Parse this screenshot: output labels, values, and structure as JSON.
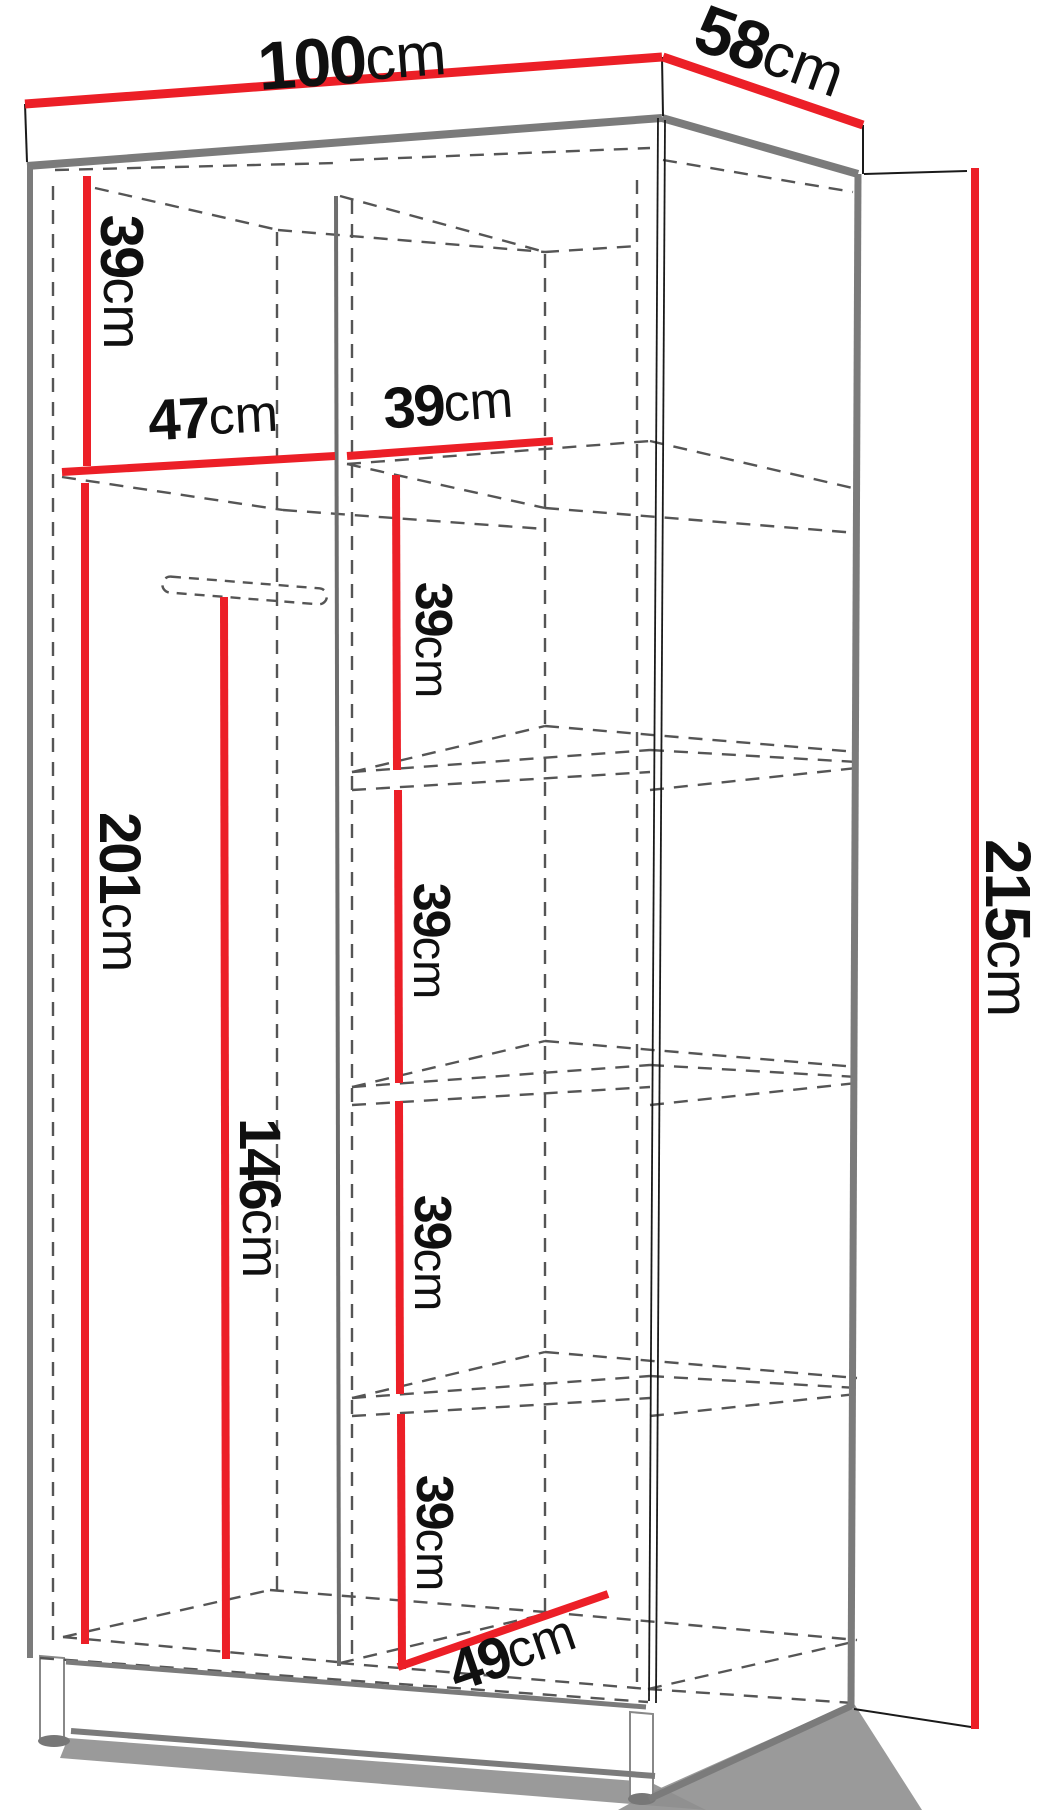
{
  "canvas": {
    "width": 1052,
    "height": 1810
  },
  "colors": {
    "dimension_red": "#ec1f27",
    "edge_gray": "#7b7b7b",
    "divider_gray": "#6e6e6e",
    "hidden_dash": "#555555",
    "thin_black": "#1a1a1a",
    "shadow_gray": "#8f8f8f",
    "foot_outline": "#888888",
    "background": "#ffffff"
  },
  "measurements_summary": {
    "overall_width": "100cm",
    "overall_depth": "58cm",
    "overall_height": "215cm",
    "top_compartment_height": "39cm",
    "left_bay_width": "47cm",
    "right_bay_width": "39cm",
    "left_bay_height": "201cm",
    "hanging_height": "146cm",
    "right_shelf_spacing": [
      "39cm",
      "39cm",
      "39cm",
      "39cm"
    ],
    "interior_depth": "49cm"
  },
  "diagram": {
    "labels": [
      {
        "name": "label-100cm",
        "value": "100",
        "unit": "cm",
        "x": 352,
        "y": 60,
        "rot": -4.3,
        "size": 68,
        "unit_size": 61
      },
      {
        "name": "label-58cm",
        "value": "58",
        "unit": "cm",
        "x": 770,
        "y": 52,
        "rot": 20,
        "size": 68,
        "unit_size": 61
      },
      {
        "name": "label-39cm-top-left",
        "value": "39",
        "unit": "cm",
        "x": 122,
        "y": 282,
        "rot": 90,
        "size": 60,
        "unit_size": 54
      },
      {
        "name": "label-47cm",
        "value": "47",
        "unit": "cm",
        "x": 213,
        "y": 417,
        "rot": -3,
        "size": 58,
        "unit_size": 52
      },
      {
        "name": "label-39cm-width",
        "value": "39",
        "unit": "cm",
        "x": 448,
        "y": 404,
        "rot": -4,
        "size": 58,
        "unit_size": 52
      },
      {
        "name": "label-201cm",
        "value": "201",
        "unit": "cm",
        "x": 120,
        "y": 892,
        "rot": 90,
        "size": 58,
        "unit_size": 52
      },
      {
        "name": "label-146cm",
        "value": "146",
        "unit": "cm",
        "x": 260,
        "y": 1198,
        "rot": 90,
        "size": 58,
        "unit_size": 52
      },
      {
        "name": "label-39cm-bay1",
        "value": "39",
        "unit": "cm",
        "x": 433,
        "y": 640,
        "rot": 90,
        "size": 52,
        "unit_size": 47
      },
      {
        "name": "label-39cm-bay2",
        "value": "39",
        "unit": "cm",
        "x": 431,
        "y": 941,
        "rot": 90,
        "size": 52,
        "unit_size": 47
      },
      {
        "name": "label-39cm-bay3",
        "value": "39",
        "unit": "cm",
        "x": 432,
        "y": 1253,
        "rot": 90,
        "size": 52,
        "unit_size": 47
      },
      {
        "name": "label-39cm-bay4",
        "value": "39",
        "unit": "cm",
        "x": 434,
        "y": 1533,
        "rot": 90,
        "size": 52,
        "unit_size": 47
      },
      {
        "name": "label-49cm",
        "value": "49",
        "unit": "cm",
        "x": 512,
        "y": 1652,
        "rot": -19,
        "size": 58,
        "unit_size": 52
      },
      {
        "name": "label-215cm",
        "value": "215",
        "unit": "cm",
        "x": 1008,
        "y": 928,
        "rot": 90,
        "size": 64,
        "unit_size": 58
      }
    ],
    "red_lines": [
      {
        "name": "dim-line-100cm",
        "x1": 25,
        "y1": 104,
        "x2": 662,
        "y2": 57,
        "w": 9
      },
      {
        "name": "dim-line-58cm",
        "x1": 663,
        "y1": 57,
        "x2": 863,
        "y2": 125,
        "w": 9
      },
      {
        "name": "dim-line-39cm-top",
        "x1": 87,
        "y1": 176,
        "x2": 87,
        "y2": 466,
        "w": 8
      },
      {
        "name": "dim-line-47cm",
        "x1": 62,
        "y1": 472,
        "x2": 335,
        "y2": 456,
        "w": 8
      },
      {
        "name": "dim-line-39cm-width",
        "x1": 347,
        "y1": 456,
        "x2": 553,
        "y2": 441,
        "w": 8
      },
      {
        "name": "dim-line-201cm",
        "x1": 85,
        "y1": 483,
        "x2": 85,
        "y2": 1644,
        "w": 8
      },
      {
        "name": "dim-line-146cm",
        "x1": 224,
        "y1": 597,
        "x2": 226,
        "y2": 1659,
        "w": 8
      },
      {
        "name": "dim-line-39cm-seg1",
        "x1": 396,
        "y1": 475,
        "x2": 397,
        "y2": 770,
        "w": 8
      },
      {
        "name": "dim-line-39cm-seg2",
        "x1": 398,
        "y1": 790,
        "x2": 399,
        "y2": 1083,
        "w": 8
      },
      {
        "name": "dim-line-39cm-seg3",
        "x1": 399,
        "y1": 1101,
        "x2": 400,
        "y2": 1394,
        "w": 8
      },
      {
        "name": "dim-line-39cm-seg4",
        "x1": 401,
        "y1": 1414,
        "x2": 402,
        "y2": 1669,
        "w": 8
      },
      {
        "name": "dim-line-49cm",
        "x1": 398,
        "y1": 1667,
        "x2": 608,
        "y2": 1594,
        "w": 8
      },
      {
        "name": "dim-line-215cm",
        "x1": 975,
        "y1": 168,
        "x2": 975,
        "y2": 1729,
        "w": 8
      }
    ],
    "gray_edges": [
      {
        "name": "edge-top-front",
        "x1": 27,
        "y1": 166,
        "x2": 662,
        "y2": 118,
        "w": 8
      },
      {
        "name": "edge-top-right",
        "x1": 662,
        "y1": 118,
        "x2": 858,
        "y2": 174,
        "w": 8
      },
      {
        "name": "edge-left",
        "x1": 30,
        "y1": 163,
        "x2": 30,
        "y2": 1658,
        "w": 6
      },
      {
        "name": "edge-back-right",
        "x1": 858,
        "y1": 174,
        "x2": 851,
        "y2": 1708,
        "w": 7
      },
      {
        "name": "edge-right-bottom",
        "x1": 851,
        "y1": 1706,
        "x2": 649,
        "y2": 1799,
        "w": 7
      },
      {
        "name": "edge-plinth-top",
        "x1": 66,
        "y1": 1662,
        "x2": 646,
        "y2": 1707,
        "w": 5
      },
      {
        "name": "edge-plinth-bottom",
        "x1": 71,
        "y1": 1731,
        "x2": 655,
        "y2": 1776,
        "w": 6
      },
      {
        "name": "edge-center-divider",
        "x1": 336,
        "y1": 196,
        "x2": 339,
        "y2": 1666,
        "w": 4
      }
    ],
    "thin_lines": [
      {
        "name": "edge-toppanel-left",
        "x1": 25,
        "y1": 104,
        "x2": 27,
        "y2": 162,
        "w": 2
      },
      {
        "name": "edge-toppanel-corner",
        "x1": 662,
        "y1": 57,
        "x2": 663,
        "y2": 116,
        "w": 2
      },
      {
        "name": "edge-toppanel-backcorner",
        "x1": 863,
        "y1": 125,
        "x2": 863,
        "y2": 174,
        "w": 2
      },
      {
        "name": "extension-line-top",
        "x1": 864,
        "y1": 174,
        "x2": 967,
        "y2": 171,
        "w": 2
      },
      {
        "name": "extension-line-bottom",
        "x1": 854,
        "y1": 1709,
        "x2": 971,
        "y2": 1727,
        "w": 2
      },
      {
        "name": "edge-front-right-a",
        "x1": 658,
        "y1": 118,
        "x2": 649,
        "y2": 1701,
        "w": 1.8
      },
      {
        "name": "edge-front-right-b",
        "x1": 665,
        "y1": 120,
        "x2": 656,
        "y2": 1703,
        "w": 1.8
      }
    ],
    "dashed_lines": [
      {
        "name": "hidden-top-underside-left",
        "x1": 55,
        "y1": 170,
        "x2": 335,
        "y2": 163
      },
      {
        "name": "hidden-top-underside-right",
        "x1": 350,
        "y1": 160,
        "x2": 650,
        "y2": 148
      },
      {
        "name": "hidden-top-back-diag-left",
        "x1": 95,
        "y1": 188,
        "x2": 278,
        "y2": 230
      },
      {
        "name": "hidden-top-back-left",
        "x1": 278,
        "y1": 230,
        "x2": 545,
        "y2": 252
      },
      {
        "name": "hidden-top-divider-diag",
        "x1": 340,
        "y1": 196,
        "x2": 545,
        "y2": 252
      },
      {
        "name": "hidden-top-back-right",
        "x1": 545,
        "y1": 252,
        "x2": 637,
        "y2": 246
      },
      {
        "name": "hidden-top-rightwall",
        "x1": 663,
        "y1": 160,
        "x2": 853,
        "y2": 192
      },
      {
        "name": "hidden-left-inner",
        "x1": 53,
        "y1": 186,
        "x2": 53,
        "y2": 1650
      },
      {
        "name": "hidden-back-left-corner",
        "x1": 277,
        "y1": 232,
        "x2": 277,
        "y2": 1590
      },
      {
        "name": "hidden-divider-front2",
        "x1": 352,
        "y1": 200,
        "x2": 352,
        "y2": 1663
      },
      {
        "name": "hidden-divider-back",
        "x1": 545,
        "y1": 254,
        "x2": 545,
        "y2": 1612
      },
      {
        "name": "hidden-rightwall-back",
        "x1": 637,
        "y1": 180,
        "x2": 637,
        "y2": 1692
      },
      {
        "name": "shelf0-left-diag",
        "x1": 62,
        "y1": 477,
        "x2": 283,
        "y2": 510
      },
      {
        "name": "shelf0-left-back",
        "x1": 283,
        "y1": 510,
        "x2": 545,
        "y2": 529
      },
      {
        "name": "shelf0-right-under",
        "x1": 347,
        "y1": 464,
        "x2": 650,
        "y2": 441
      },
      {
        "name": "shelf0-right-diag",
        "x1": 347,
        "y1": 464,
        "x2": 545,
        "y2": 508
      },
      {
        "name": "shelf0-right-back",
        "x1": 545,
        "y1": 508,
        "x2": 857,
        "y2": 533
      },
      {
        "name": "shelf0-panel-cross",
        "x1": 650,
        "y1": 441,
        "x2": 857,
        "y2": 489
      },
      {
        "name": "shelf1-front-top",
        "x1": 352,
        "y1": 772,
        "x2": 650,
        "y2": 750
      },
      {
        "name": "shelf1-front-bottom",
        "x1": 352,
        "y1": 790,
        "x2": 650,
        "y2": 772
      },
      {
        "name": "shelf1-left-diag",
        "x1": 352,
        "y1": 772,
        "x2": 545,
        "y2": 726
      },
      {
        "name": "shelf1-back",
        "x1": 545,
        "y1": 726,
        "x2": 857,
        "y2": 752
      },
      {
        "name": "shelf1-panel-cross-top",
        "x1": 650,
        "y1": 750,
        "x2": 857,
        "y2": 762
      },
      {
        "name": "shelf1-panel-cross-bottom",
        "x1": 650,
        "y1": 790,
        "x2": 857,
        "y2": 768
      },
      {
        "name": "shelf2-front-top",
        "x1": 352,
        "y1": 1087,
        "x2": 650,
        "y2": 1065
      },
      {
        "name": "shelf2-front-bottom",
        "x1": 352,
        "y1": 1105,
        "x2": 650,
        "y2": 1087
      },
      {
        "name": "shelf2-left-diag",
        "x1": 352,
        "y1": 1087,
        "x2": 545,
        "y2": 1041
      },
      {
        "name": "shelf2-back",
        "x1": 545,
        "y1": 1041,
        "x2": 857,
        "y2": 1067
      },
      {
        "name": "shelf2-panel-cross-top",
        "x1": 650,
        "y1": 1065,
        "x2": 857,
        "y2": 1077
      },
      {
        "name": "shelf2-panel-cross-bottom",
        "x1": 650,
        "y1": 1105,
        "x2": 857,
        "y2": 1083
      },
      {
        "name": "shelf3-front-top",
        "x1": 352,
        "y1": 1398,
        "x2": 650,
        "y2": 1376
      },
      {
        "name": "shelf3-front-bottom",
        "x1": 352,
        "y1": 1416,
        "x2": 650,
        "y2": 1398
      },
      {
        "name": "shelf3-left-diag",
        "x1": 352,
        "y1": 1398,
        "x2": 545,
        "y2": 1352
      },
      {
        "name": "shelf3-back",
        "x1": 545,
        "y1": 1352,
        "x2": 857,
        "y2": 1378
      },
      {
        "name": "shelf3-panel-cross-top",
        "x1": 650,
        "y1": 1376,
        "x2": 857,
        "y2": 1388
      },
      {
        "name": "shelf3-panel-cross-bottom",
        "x1": 650,
        "y1": 1416,
        "x2": 857,
        "y2": 1394
      },
      {
        "name": "floor-front-left",
        "x1": 63,
        "y1": 1637,
        "x2": 337,
        "y2": 1662
      },
      {
        "name": "floor-front-right",
        "x1": 340,
        "y1": 1663,
        "x2": 648,
        "y2": 1689
      },
      {
        "name": "floor-left-diag",
        "x1": 63,
        "y1": 1637,
        "x2": 270,
        "y2": 1590
      },
      {
        "name": "floor-back-left",
        "x1": 270,
        "y1": 1590,
        "x2": 545,
        "y2": 1612
      },
      {
        "name": "floor-back-right",
        "x1": 545,
        "y1": 1612,
        "x2": 857,
        "y2": 1640
      },
      {
        "name": "floor-divider-diag",
        "x1": 340,
        "y1": 1663,
        "x2": 545,
        "y2": 1614
      },
      {
        "name": "floor-right-diag",
        "x1": 648,
        "y1": 1689,
        "x2": 857,
        "y2": 1641
      },
      {
        "name": "hidden-bottom-front",
        "x1": 40,
        "y1": 1658,
        "x2": 648,
        "y2": 1702
      },
      {
        "name": "hidden-bottom-right-cross",
        "x1": 648,
        "y1": 1689,
        "x2": 853,
        "y2": 1703
      }
    ],
    "rail": {
      "name": "hanging-rail",
      "x": 163,
      "y": 576,
      "w": 165,
      "h": 16,
      "rx": 8,
      "rot": 4.5
    },
    "polygons": [
      {
        "name": "shadow-plinth",
        "points": "68,1738 650,1782 706,1810 60,1758",
        "fill": "#8f8f8f",
        "opacity": 0.9
      },
      {
        "name": "shadow-right-panel",
        "points": "853,1702 922,1810 618,1810 645,1795",
        "fill": "#8f8f8f",
        "opacity": 0.9
      },
      {
        "name": "panel-top-front",
        "points": "25,104 662,57 663,115 27,163",
        "fill": "#ffffff"
      },
      {
        "name": "panel-top-side",
        "points": "663,57 863,125 863,175 664,117",
        "fill": "#ffffff"
      },
      {
        "name": "panel-right-side",
        "points": "662,117 858,175 851,1707 649,1704",
        "fill": "#ffffff"
      },
      {
        "name": "panel-plinth-front",
        "points": "66,1661 646,1706 654,1773 72,1729",
        "fill": "#ffffff"
      },
      {
        "name": "foot-left",
        "points": "40,1656 64,1658 64,1740 40,1738",
        "fill": "#ffffff",
        "stroke": "#888888"
      },
      {
        "name": "foot-right",
        "points": "630,1712 653,1714 653,1798 630,1796",
        "fill": "#ffffff",
        "stroke": "#888888"
      }
    ],
    "ellipses": [
      {
        "name": "shadow-foot-left",
        "cx": 54,
        "cy": 1741,
        "rx": 16,
        "ry": 6,
        "fill": "#777777"
      },
      {
        "name": "shadow-foot-right",
        "cx": 642,
        "cy": 1799,
        "rx": 14,
        "ry": 6,
        "fill": "#777777"
      }
    ]
  }
}
